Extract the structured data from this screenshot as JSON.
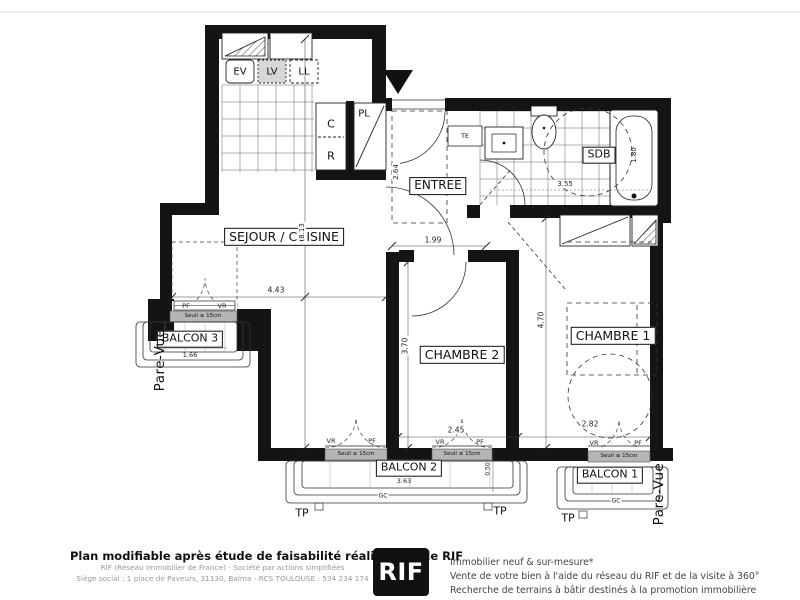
{
  "plan": {
    "rooms": {
      "sejour": "SEJOUR / CUISINE",
      "entree": "ENTREE",
      "sdb": "SDB",
      "chambre1": "CHAMBRE 1",
      "chambre2": "CHAMBRE 2",
      "balcon1": "BALCON 1",
      "balcon2": "BALCON 2",
      "balcon3": "BALCON 3"
    },
    "fixtures": {
      "ev": "EV",
      "lv": "LV",
      "ll": "LL",
      "c": "C",
      "r": "R",
      "pl": "PL",
      "te": "TE"
    },
    "dims": {
      "sejour_width": "4.43",
      "total_depth": "8.13",
      "entree_depth": "2.64",
      "entree_width": "1.99",
      "sdb_width": "3.55",
      "bath_length": "1.80",
      "chambre2_height": "3.70",
      "chambre1_height": "4.70",
      "chambre2_width": "2.45",
      "chambre1_width": "2.82",
      "balcon3_width": "1.66",
      "balcon2_width": "3.63",
      "balcony_depth": "0.50"
    },
    "windows": {
      "pf": "PF",
      "vr": "VR",
      "seuil": "Seuil ≤ 15cm"
    },
    "annotations": {
      "tp": "TP",
      "gc": "GC",
      "pare_vue": "Pare-Vue"
    }
  },
  "footer": {
    "left_bold": "Plan modifiable après étude de faisabilité réalisée par le RIF",
    "left_line1": "RIF (Réseau Immobilier de France) - Société par actions simplifiées",
    "left_line2": "Siège social : 1 place de Paveurs, 31130, Balma - RCS TOULOUSE : 534 234 174",
    "logo": "RIF",
    "right_line1": "Immobilier neuf & sur-mesure*",
    "right_line2": "Vente de votre bien à l'aide du réseau du RIF et de la visite à 360°",
    "right_line3": "Recherche de terrains à bâtir destinés à la promotion immobilière"
  }
}
